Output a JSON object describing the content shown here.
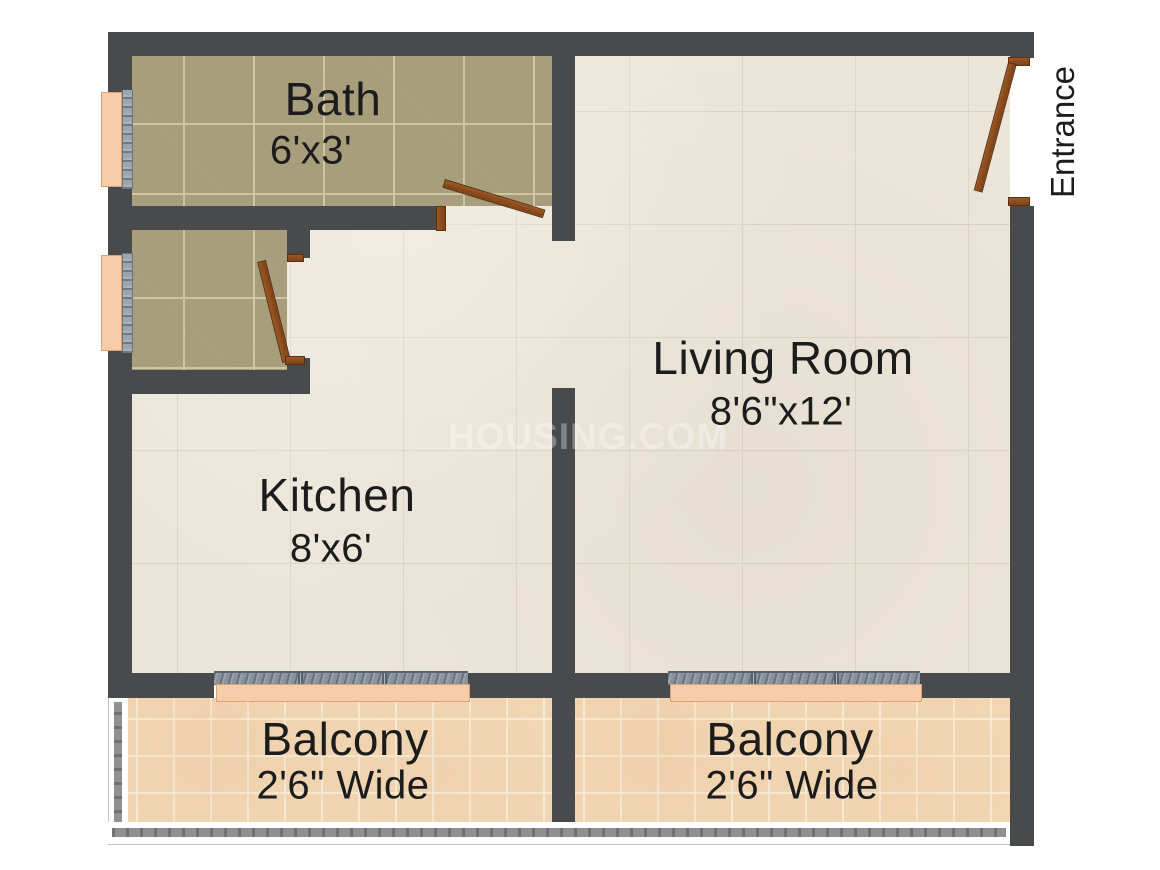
{
  "meta": {
    "type": "apartment-floor-plan"
  },
  "plan": {
    "watermark": "HOUSING.COM",
    "entrance_label": "Entrance",
    "rooms": [
      {
        "id": "bath",
        "name": "Bath",
        "dims": "6'x3'"
      },
      {
        "id": "kitchen",
        "name": "Kitchen",
        "dims": "8'x6'"
      },
      {
        "id": "living-room",
        "name": "Living Room",
        "dims": "8'6\"x12'"
      },
      {
        "id": "balcony-left",
        "name": "Balcony",
        "dims": "2'6\" Wide"
      },
      {
        "id": "balcony-right",
        "name": "Balcony",
        "dims": "2'6\" Wide"
      }
    ],
    "colors": {
      "wall": "#494a4c",
      "floor_main": "#ece6d9",
      "floor_bath": "#a69c7a",
      "floor_balcony": "#f3d9b8",
      "door": "#8d4e1f",
      "window_sill": "#f6cda8",
      "window_glass": "#87939c",
      "label_text": "#1c1c1c"
    }
  }
}
